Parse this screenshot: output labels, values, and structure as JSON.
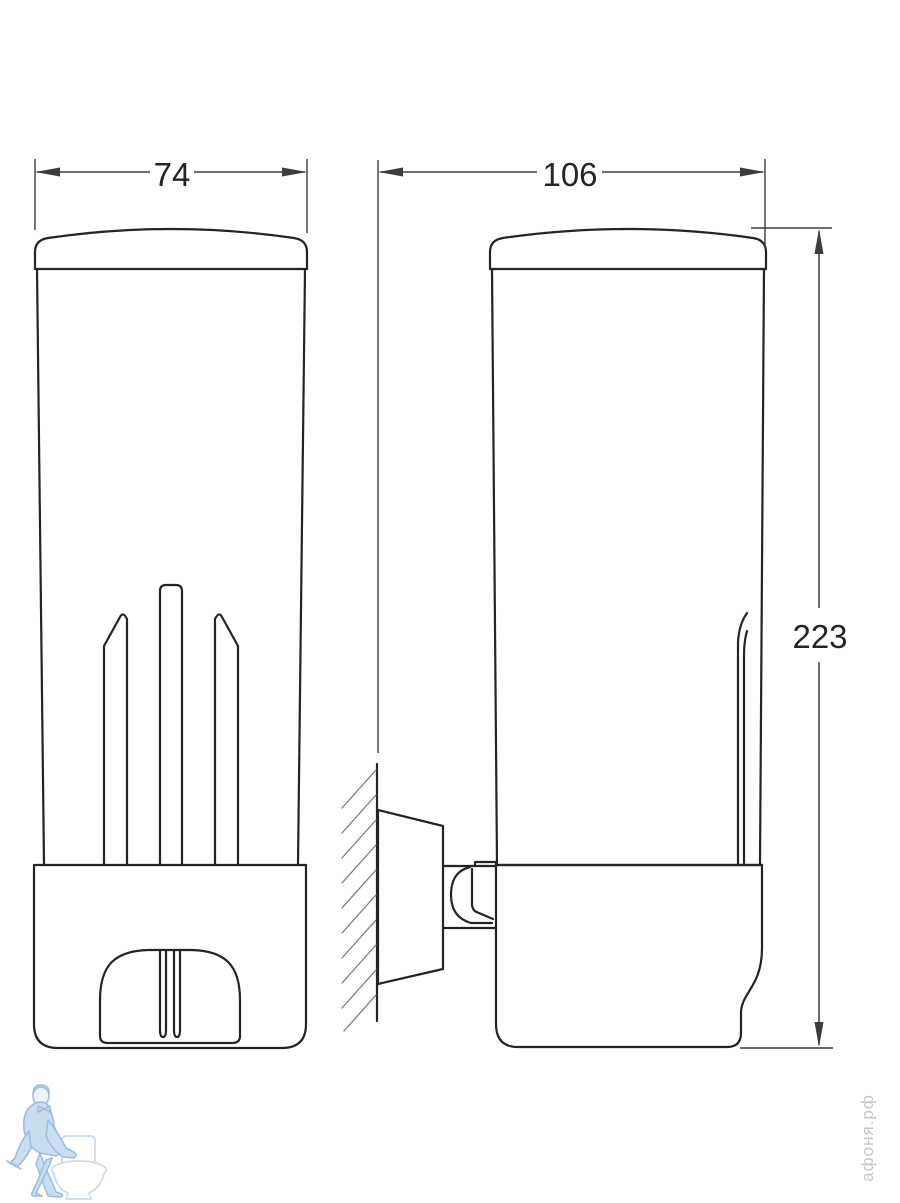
{
  "dimensions": {
    "front_width": "74",
    "side_depth": "106",
    "height": "223"
  },
  "watermarks": {
    "site_vertical_text": "афоня.рф"
  },
  "colors": {
    "line": "#242424",
    "dim_line": "#3c3c3c",
    "hatch": "#7a7a7a",
    "wm_blue_stroke": "#9cbede",
    "wm_blue_fill": "#c9ddf1",
    "wm_light_stroke": "#ccdcea",
    "wm_gray": "#c6c6c6",
    "background": "#ffffff"
  }
}
